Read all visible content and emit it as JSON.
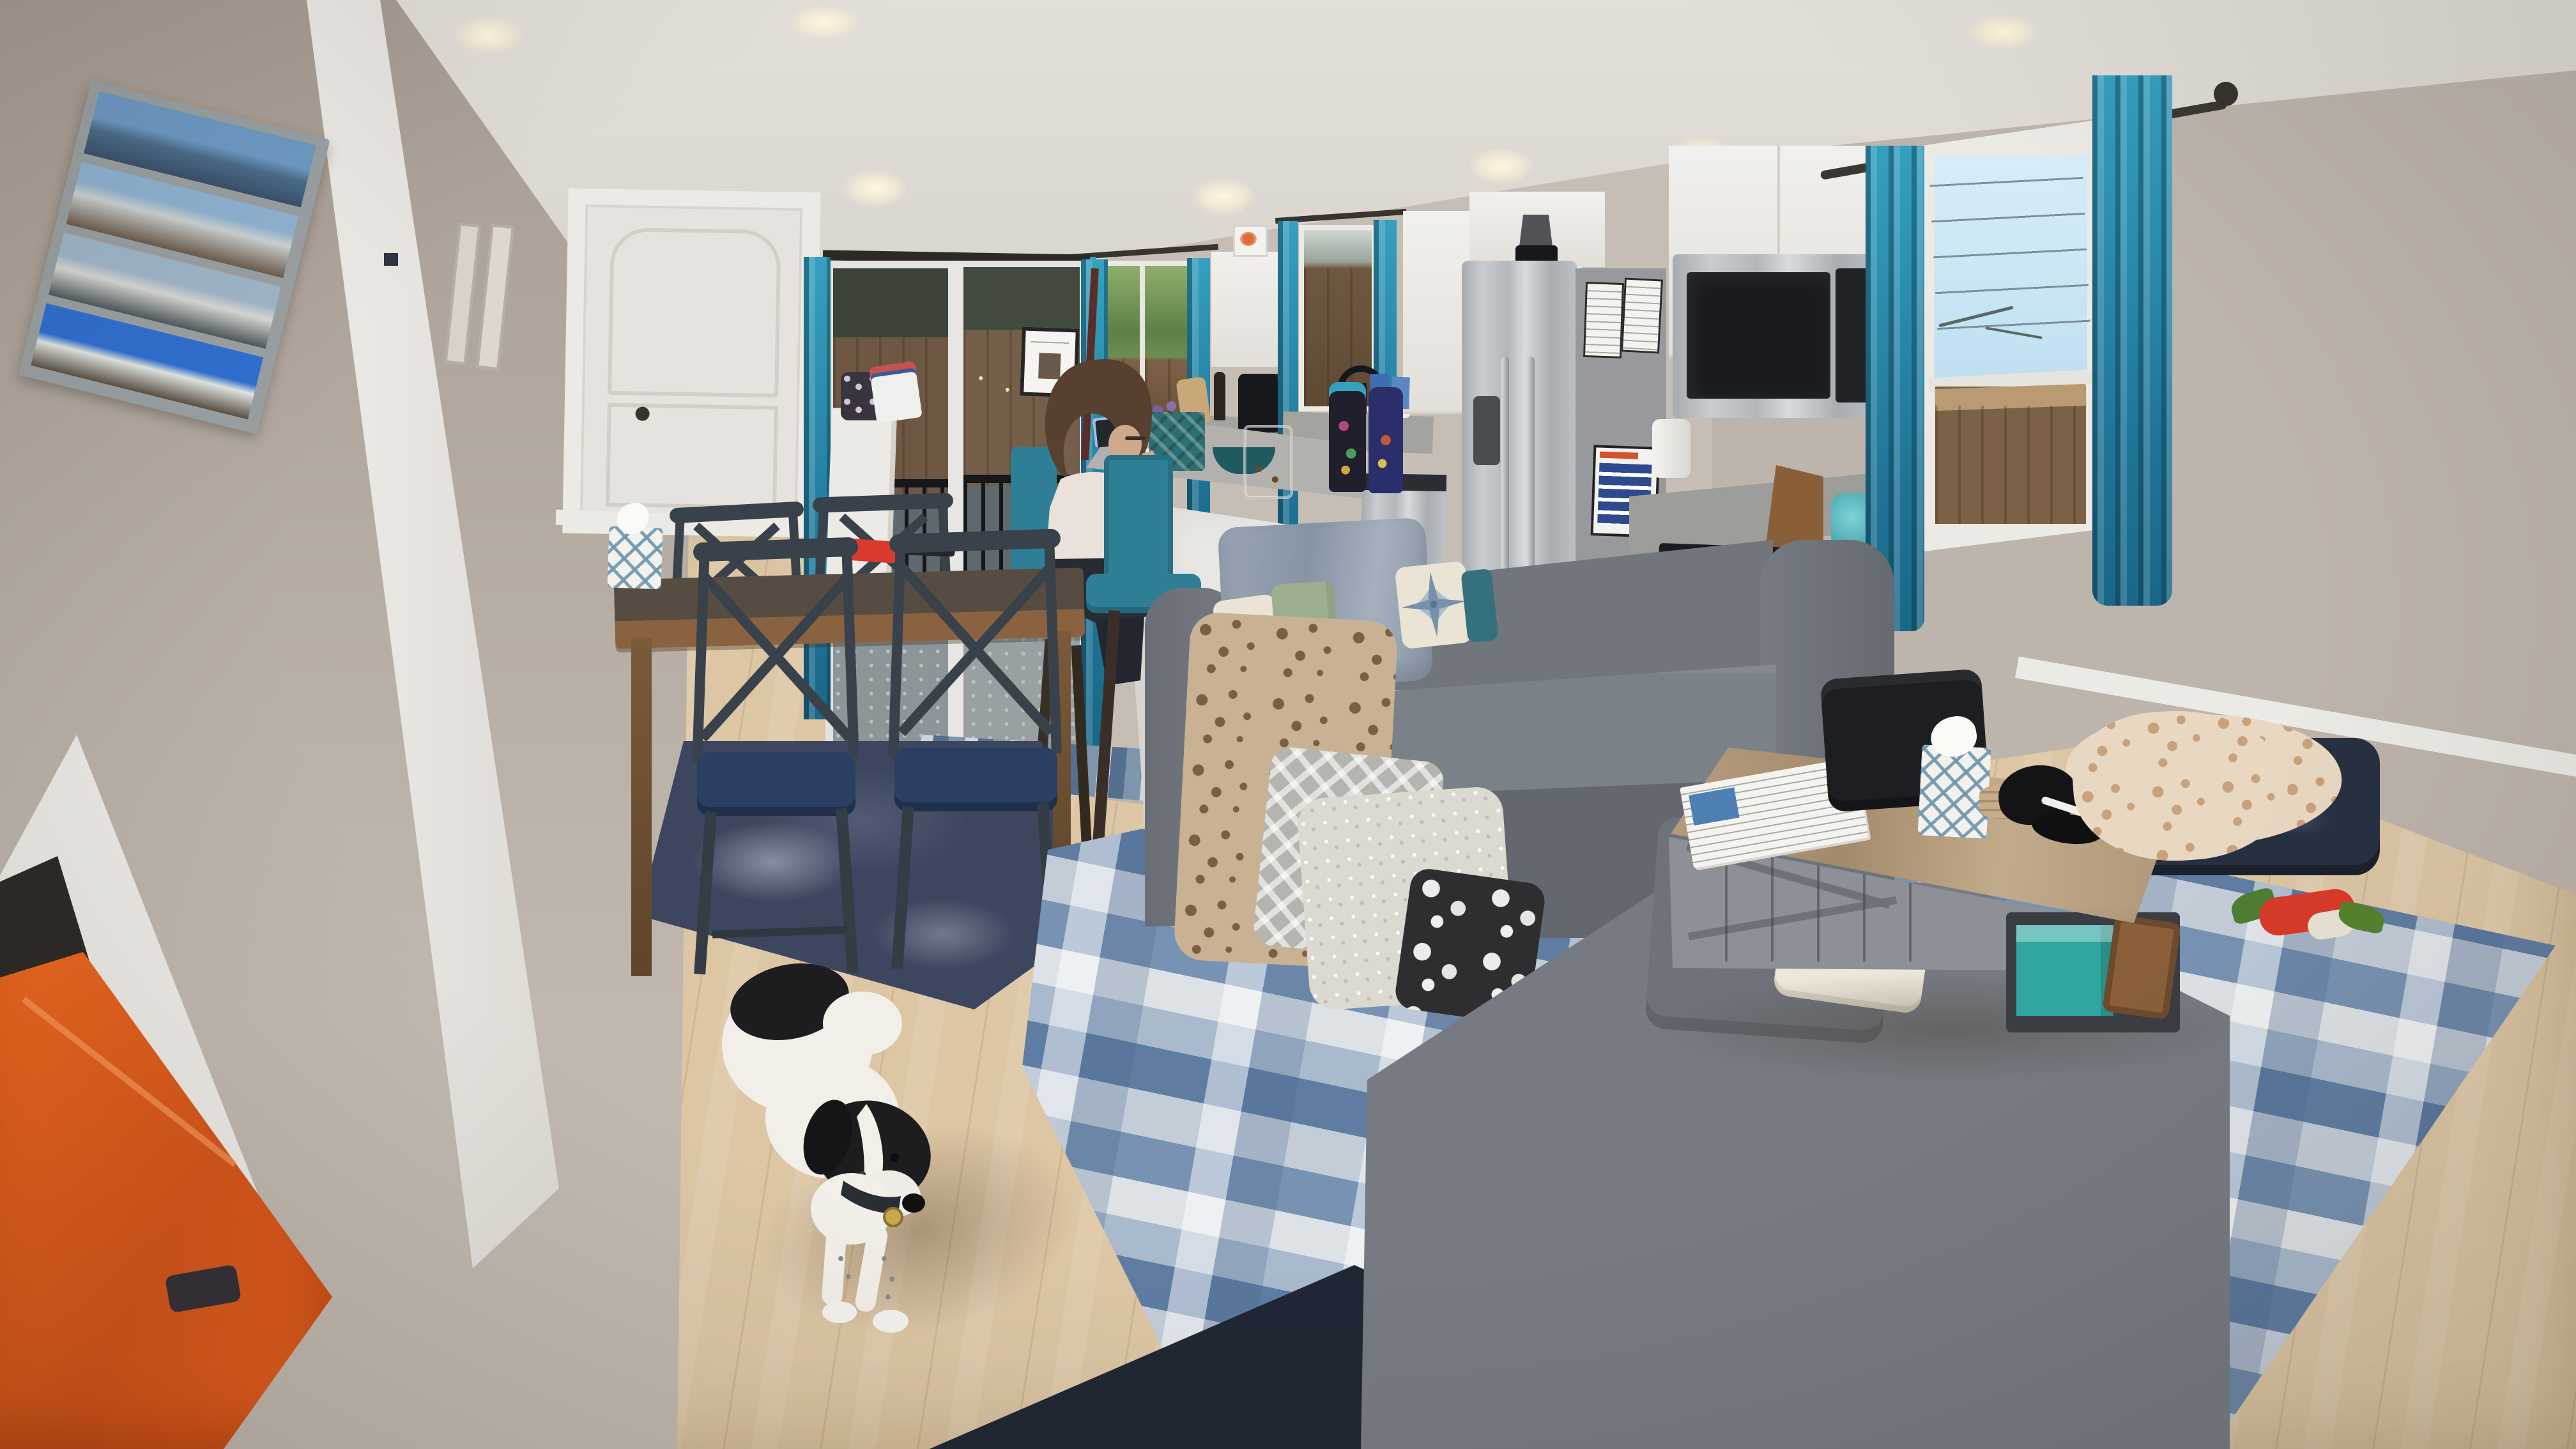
{
  "scene": {
    "type": "natural-photo",
    "setting": "open-concept living room with dining nook and kitchen",
    "time": "evening, interior recessed lights on",
    "description": "Wide-angle evening photo of an open-concept living room: gray sectional sofa with teal, sage and compass-rose pillows and draped blankets, gray barn-door coffee table with tissue box and black cap, blue distressed rugs on light wood flooring, dining nook with wood table and navy cross-back chairs, kitchen with white cabinets, stainless fridge with papers, teal curtains and bar stools, a person seated at the island, a black-and-white dog standing in the foreground, and bright orange fabric at bottom left."
  },
  "palette": {
    "wall": "#bdb4ab",
    "wall_left": "#aba095",
    "wall_kitchen": "#c6beb4",
    "ceiling": "#d9d3cc",
    "trim": "#eceae5",
    "floor": "#dcc6a4",
    "accent_teal": "#2a87a8",
    "curtain_teal": "#2586a6",
    "sofa": "#71767d",
    "sofa_seat": "#7b8189",
    "sofa_skirt": "#63676e",
    "rug_blue": "#9db0c5",
    "rug_navy": "#1f2734",
    "rug_dining": "#3c465e",
    "table_wood": "#7a5a38",
    "island_white": "#e9e7e3",
    "counter": "#a3a3a0",
    "cabinet": "#eceae6",
    "steel": "#b9bcbf",
    "fridge_side": "#97999c",
    "oven_black": "#17191d",
    "towel_teal": "#69c4c9",
    "stool_teal": "#2e7f96",
    "shirt": "#eae2da",
    "hair": "#57402f",
    "pants": "#272b33",
    "pillow_sage": "#9cb08f",
    "pillow_cream": "#e8e2d0",
    "pillow_teal": "#35707f",
    "blanket_bluegray": "#95a1b0",
    "leopard_base": "#c9b293",
    "leopard_spot": "#7c5f43",
    "dog_white": "#f2efe9",
    "dog_black": "#1d1d1f",
    "orange": "#e8641f",
    "door_white": "#e6e3df",
    "glass_sky": "#cfe9f7",
    "fence": "#7d6147",
    "greenery": "#6a8f56",
    "binder_blue": "#4d7fb5",
    "game_teal": "#2fa7a0",
    "toy_red": "#d93a2b",
    "toy_green": "#4e7d32",
    "cap_black": "#141417",
    "case_black": "#1c1e22",
    "tag_gold": "#c9a84c",
    "dark_gap": "#2b2926",
    "railing_black": "#15171a"
  },
  "objects": {
    "left_wall": {
      "beach_photo_frame": {
        "label": "weathered gray frame with four stacked beach photos",
        "photo_count": 4
      },
      "small_frames": {
        "label": "two slim beige wall frames",
        "count": 2
      },
      "switch": {
        "label": "small dark wall switch"
      }
    },
    "dining": {
      "door": {
        "label": "closed white two-panel door with dark knob"
      },
      "table": {
        "label": "wood dining table with dark top"
      },
      "chair": {
        "label": "dark cross-back dining chair with navy cushion"
      },
      "chairs_count": 4,
      "rug": {
        "label": "distressed navy area rug"
      },
      "tissue_box": {
        "label": "white lattice tissue box"
      },
      "red_box": {
        "label": "small red box on table"
      },
      "dark_item": {
        "label": "dark wallet on table"
      }
    },
    "kitchen": {
      "sliding_door": {
        "label": "sliding glass door to backyard deck with black railing and sign"
      },
      "runner_rug": {
        "label": "blue striped runner rug"
      },
      "pony_wall": {
        "label": "white half wall with pouch and bag"
      },
      "window_backyard": {
        "label": "window with backyard fence and greenery view"
      },
      "window_sink": {
        "label": "window over sink with teal curtains"
      },
      "faucet": {
        "label": "black gooseneck faucet"
      },
      "cabinets": {
        "label": "white shaker cabinets"
      },
      "crab_art": {
        "label": "small framed art atop cabinet"
      },
      "coffee_maker": {
        "label": "black single-serve coffee maker"
      },
      "fridge": {
        "label": "stainless side-by-side refrigerator with posted papers",
        "papers_count": 3
      },
      "blender": {
        "label": "blender stored atop fridge cabinet"
      },
      "microwave": {
        "label": "over-range stainless microwave"
      },
      "range": {
        "label": "stainless range with black cooktop and teal towel"
      },
      "dishwasher": {
        "label": "stainless dishwasher"
      },
      "knife_block": {
        "label": "wood knife block"
      },
      "kettle": {
        "label": "teal kettle"
      },
      "island": {
        "label": "white kitchen island with gray top"
      },
      "island_items": {
        "label": "tablet, teal tissue box, snack jar, water bottles, teal bowl, flowers"
      },
      "stools": {
        "label": "teal upholstered bar stools",
        "count": 2
      },
      "wall_art": {
        "label": "dark framed warm-toned artwork beside fridge"
      },
      "floor_mat": {
        "label": "small gray kitchen mat"
      }
    },
    "living": {
      "sofa": {
        "label": "gray sectional sofa with chaise"
      },
      "pillows": {
        "label": "white, sage, compass-rose, teal and cream pillows",
        "count": 6
      },
      "blanket_bluegray": {
        "label": "blue-gray plush blanket over sofa back"
      },
      "blanket_leopard": {
        "label": "leopard print blanket"
      },
      "blanket_gray_diamond": {
        "label": "gray diamond-textured blanket"
      },
      "blanket_sherpa": {
        "label": "cream sherpa blanket"
      },
      "blanket_bw": {
        "label": "black and white patterned blanket"
      },
      "coffee_table": {
        "label": "gray barn-door coffee table with wood top"
      },
      "coffee_table_items": {
        "label": "white binder, black case, lattice tissue box, coasters, black cap"
      },
      "game_box": {
        "label": "teal board game box on shelf"
      },
      "tray": {
        "label": "wood tray on shelf"
      },
      "rug_blue": {
        "label": "blue and white distressed area rug"
      },
      "rug_navy": {
        "label": "dark navy rug at bottom edge"
      }
    },
    "right_wall": {
      "window": {
        "label": "window with teal grommet curtains, sky with power lines and fence view",
        "power_lines": 5
      },
      "curtain_rod": {
        "label": "dark metal curtain rod with ball finial"
      },
      "dog_bed": {
        "label": "navy dog bed with leopard throw"
      },
      "dog_toy": {
        "label": "red and green plush dog toy"
      }
    },
    "people": {
      "person": {
        "label": "person with shoulder-length brown hair seated at island on teal stool"
      }
    },
    "pets": {
      "dog": {
        "label": "black-and-white dog standing on wood floor looking right"
      }
    },
    "lighting": {
      "recessed_lights_count": 7
    }
  }
}
